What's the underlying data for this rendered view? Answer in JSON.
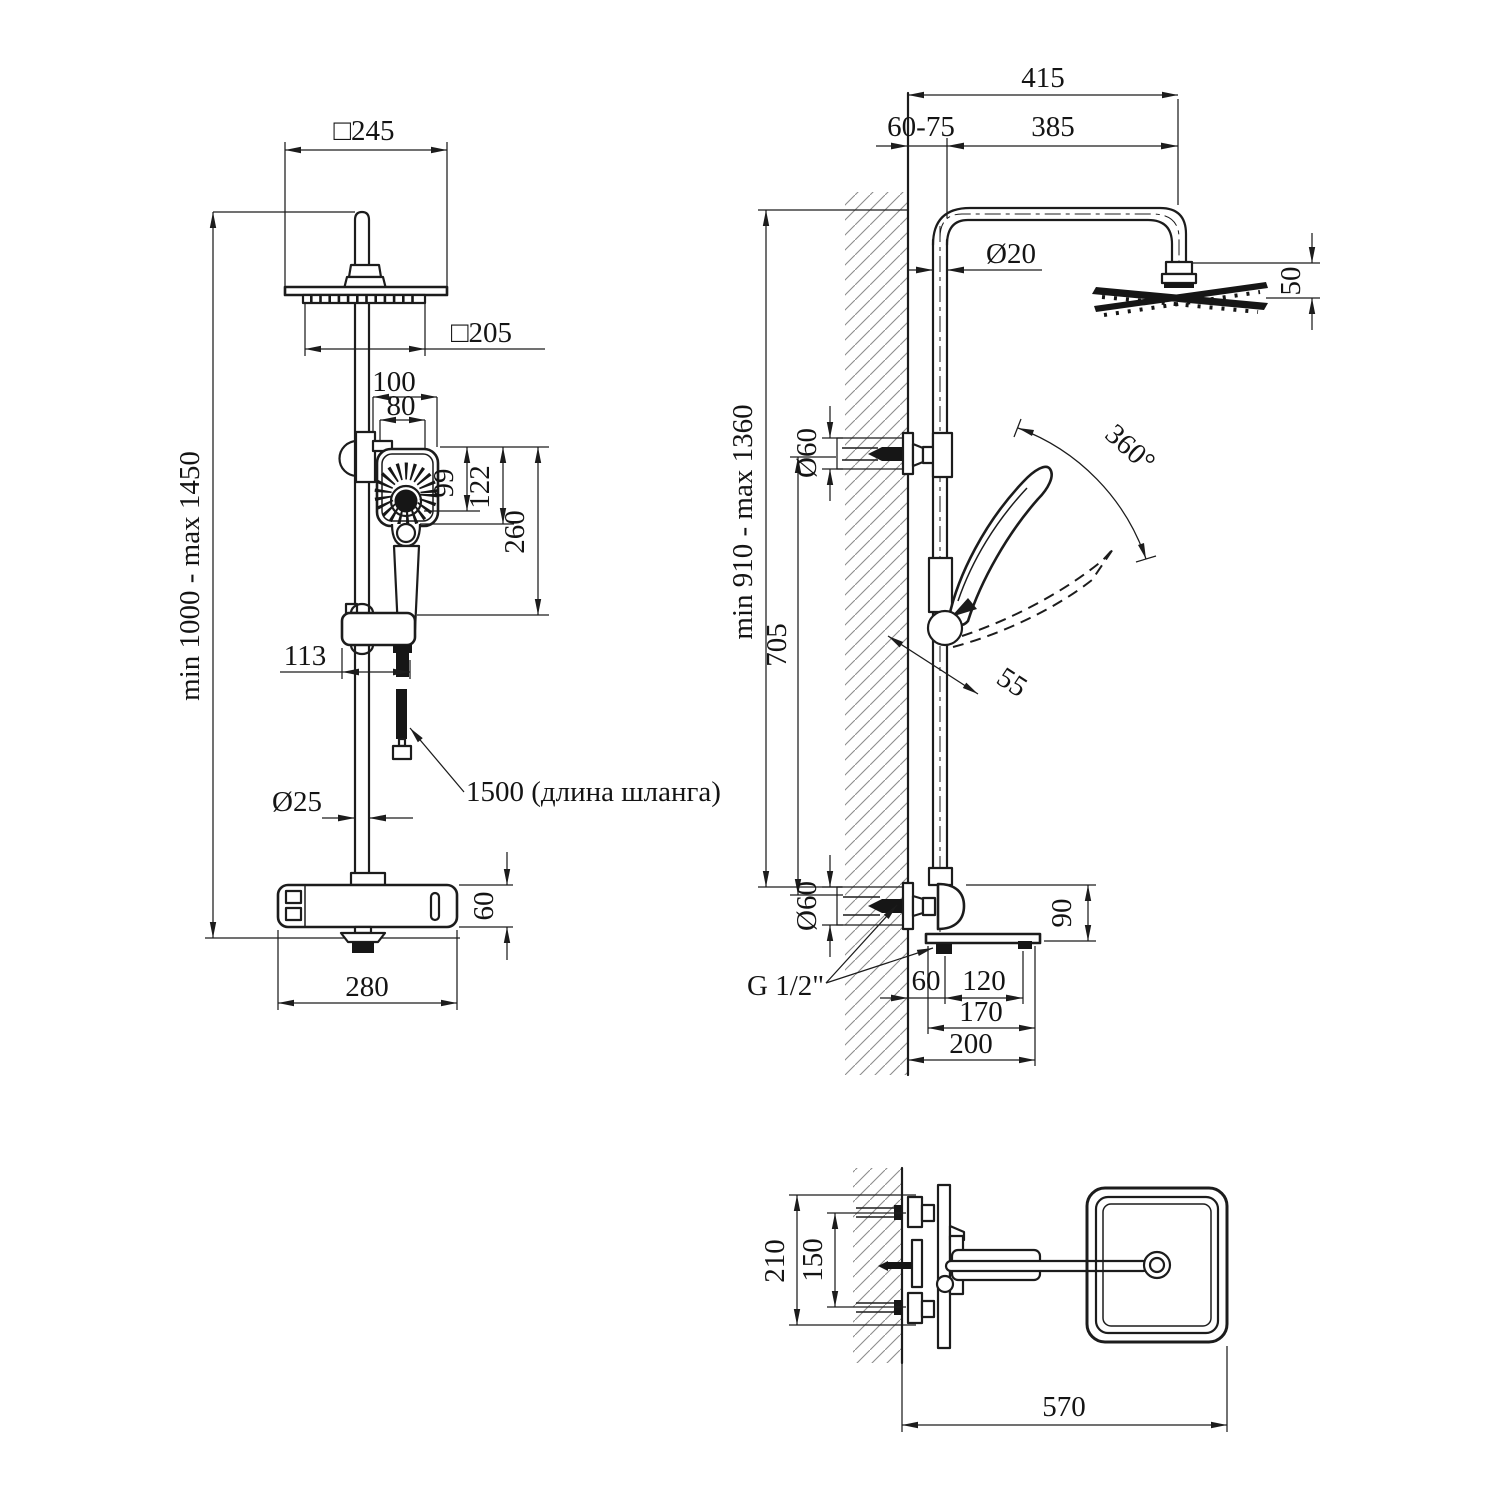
{
  "drawing_type": "shower-system-technical-drawing",
  "colors": {
    "ink": "#1c1c1c",
    "hatch": "#8d8d8d",
    "background": "#ffffff"
  },
  "front_view": {
    "overall_height": "min 1000 - max 1450",
    "head_width": "□245",
    "spray_plate_width": "□205",
    "handset_width": "100",
    "handset_face_width": "80",
    "dim_99": "99",
    "dim_122": "122",
    "handset_length": "260",
    "bracket_offset": "113",
    "pipe_diameter": "Ø25",
    "hose_length_note": "1500 (длина шланга)",
    "mixer_height": "60",
    "mixer_width": "280"
  },
  "side_view": {
    "arm_total": "415",
    "wall_adjust": "60-75",
    "arm_length": "385",
    "pipe_diameter": "Ø20",
    "head_drop": "50",
    "handset_rotation": "360°",
    "column_height": "min 910 - max 1360",
    "bracket_distance": "705",
    "escutcheon_top": "Ø60",
    "escutcheon_bottom": "Ø60",
    "handset_offset": "55",
    "spout_height": "90",
    "thread_size": "G 1/2\"",
    "spout_wall_gap": "60",
    "spout_tab_span": "120",
    "spout_length": "170",
    "spout_total": "200"
  },
  "top_view": {
    "body_span": "210",
    "inlet_spacing": "150",
    "total_projection": "570"
  }
}
